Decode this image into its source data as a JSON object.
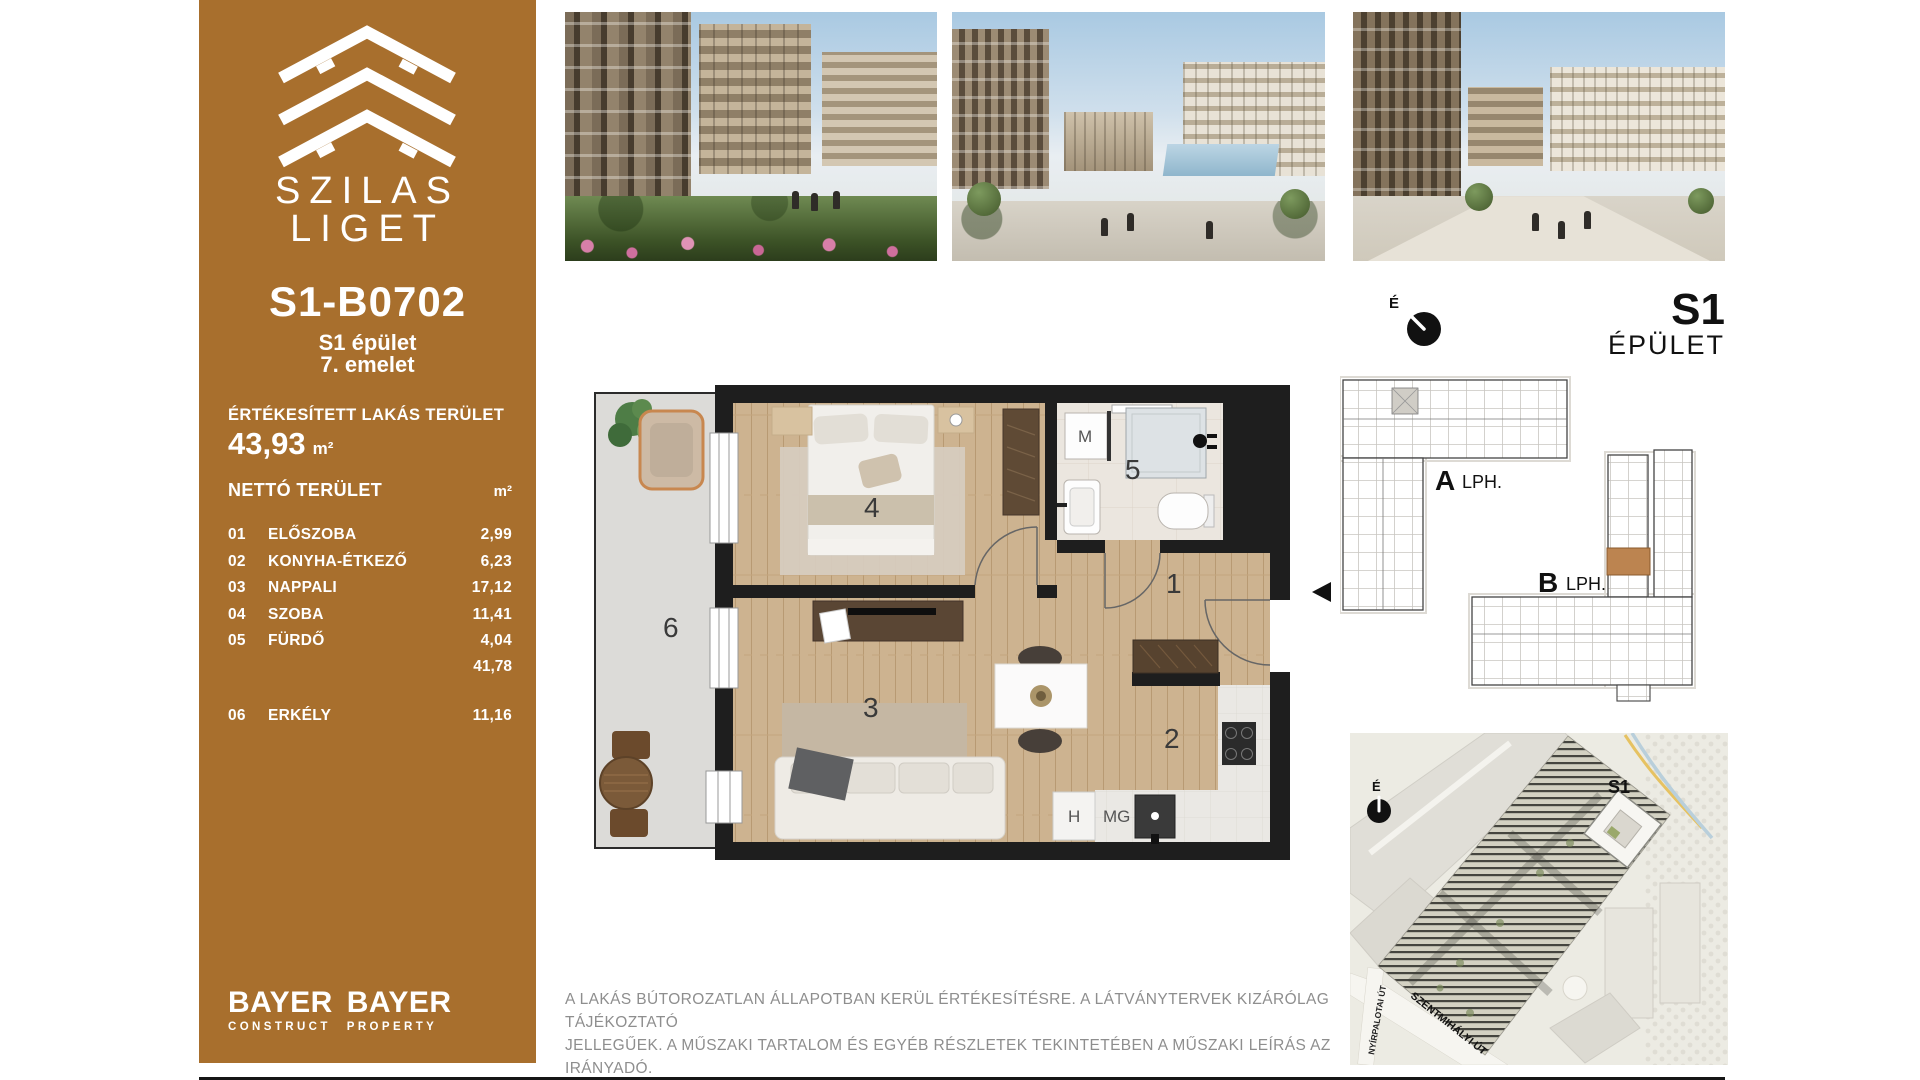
{
  "brand": {
    "line1": "SZILAS",
    "line2": "LIGET"
  },
  "sidebar": {
    "unit_id": "S1-B0702",
    "building": "S1 épület",
    "floor": "7. emelet",
    "sold_area_label": "ÉRTÉKESÍTETT LAKÁS TERÜLET",
    "sold_area_value": "43,93",
    "sold_area_unit": "m²",
    "net_area_label": "NETTÓ TERÜLET",
    "net_area_unit": "m²",
    "rooms": [
      {
        "no": "01",
        "name": "ELŐSZOBA",
        "area": "2,99"
      },
      {
        "no": "02",
        "name": "KONYHA-ÉTKEZŐ",
        "area": "6,23"
      },
      {
        "no": "03",
        "name": "NAPPALI",
        "area": "17,12"
      },
      {
        "no": "04",
        "name": "SZOBA",
        "area": "11,41"
      },
      {
        "no": "05",
        "name": "FÜRDŐ",
        "area": "4,04"
      }
    ],
    "net_total": "41,78",
    "balcony": {
      "no": "06",
      "name": "ERKÉLY",
      "area": "11,16"
    },
    "logo1": {
      "name": "BAYER",
      "sub": "CONSTRUCT"
    },
    "logo2": {
      "name": "BAYER",
      "sub": "PROPERTY"
    }
  },
  "floorplan": {
    "numbers": {
      "hall": "1",
      "kitchen": "2",
      "living": "3",
      "bedroom": "4",
      "bathroom": "5",
      "balcony": "6"
    },
    "labels": {
      "washing_machine": "M",
      "fridge": "H",
      "dishwasher": "MG"
    }
  },
  "keyplan": {
    "compass": "É",
    "building_title": "S1",
    "building_subtitle": "ÉPÜLET",
    "stair_a_letter": "A",
    "stair_a_label": "LPH.",
    "stair_b_letter": "B",
    "stair_b_label": "LPH."
  },
  "sitemap": {
    "compass": "É",
    "building_label": "S1",
    "street_left": "NYÍRPALOTAI ÚT",
    "street_diagonal": "SZENTMIHÁLYI ÚT"
  },
  "disclaimer": {
    "line1": "A LAKÁS BÚTOROZATLAN ÁLLAPOTBAN KERÜL ÉRTÉKESÍTÉSRE. A LÁTVÁNYTERVEK KIZÁRÓLAG TÁJÉKOZTATÓ",
    "line2": "JELLEGŰEK. A MŰSZAKI TARTALOM ÉS EGYÉB RÉSZLETEK TEKINTETÉBEN A MŰSZAKI LEÍRÁS AZ IRÁNYADÓ."
  },
  "colors": {
    "sidebar_brown": "#a86f2d",
    "wall_black": "#1e1e1e",
    "floor_wood": "#cdb390",
    "balcony_gray": "#dcdbd8",
    "bath_tile": "#ebe6df",
    "keyplan_highlight": "#bc8450"
  }
}
